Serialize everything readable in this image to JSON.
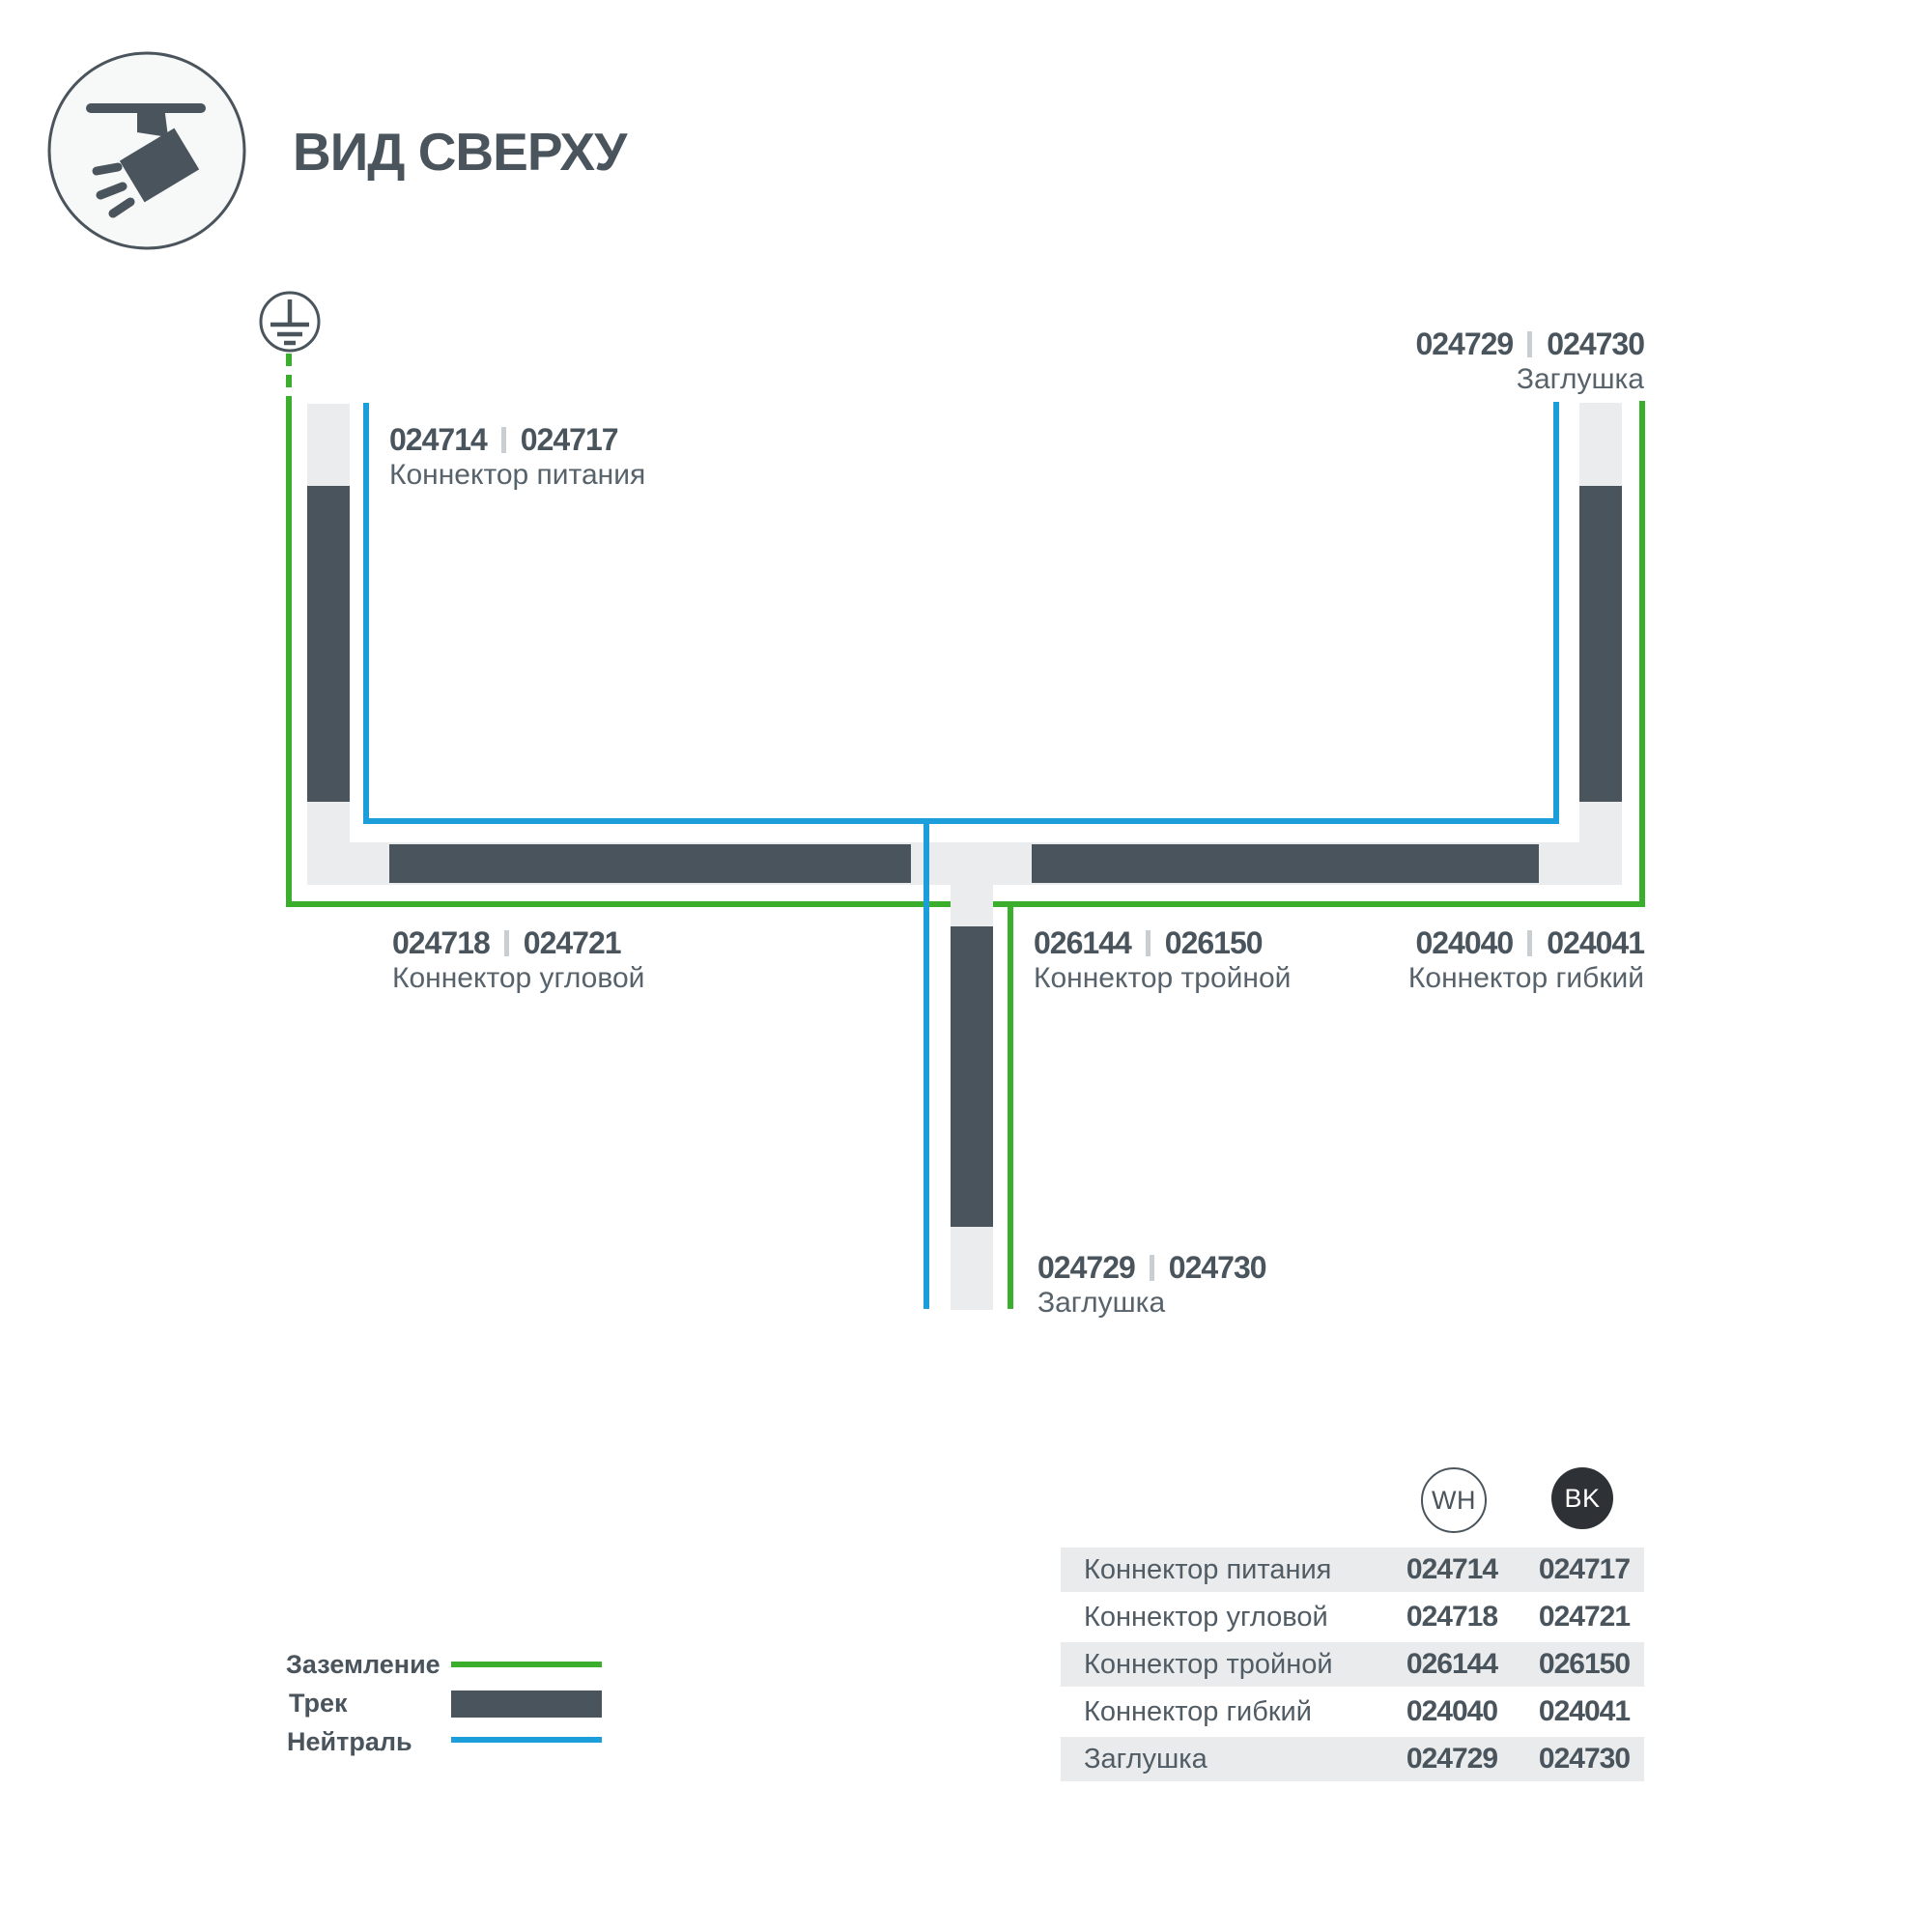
{
  "title": "ВИД СВЕРХУ",
  "icons": {
    "header": "track-spotlight-icon",
    "ground": "earth-ground-icon"
  },
  "colors": {
    "slate": "#4a545c",
    "rail_gray": "#ebeced",
    "ground_green": "#3bae2e",
    "neutral_blue": "#1b9ed9",
    "table_row_bg": "#e9ebec",
    "bk_badge": "#2e3236"
  },
  "diagram": {
    "labels": {
      "power": {
        "wh": "024714",
        "bk": "024717",
        "name": "Коннектор питания"
      },
      "endcap_top": {
        "wh": "024729",
        "bk": "024730",
        "name": "Заглушка"
      },
      "corner": {
        "wh": "024718",
        "bk": "024721",
        "name": "Коннектор угловой"
      },
      "triple": {
        "wh": "026144",
        "bk": "026150",
        "name": "Коннектор тройной"
      },
      "flex": {
        "wh": "024040",
        "bk": "024041",
        "name": "Коннектор гибкий"
      },
      "endcap_bottom": {
        "wh": "024729",
        "bk": "024730",
        "name": "Заглушка"
      }
    }
  },
  "legend": {
    "items": [
      {
        "label": "Заземление",
        "swatch": "green-line"
      },
      {
        "label": "Трек",
        "swatch": "track-bar"
      },
      {
        "label": "Нейтраль",
        "swatch": "blue-line"
      }
    ]
  },
  "table": {
    "col_wh": "WH",
    "col_bk": "BK",
    "rows": [
      {
        "label": "Коннектор питания",
        "wh": "024714",
        "bk": "024717"
      },
      {
        "label": "Коннектор угловой",
        "wh": "024718",
        "bk": "024721"
      },
      {
        "label": "Коннектор тройной",
        "wh": "026144",
        "bk": "026150"
      },
      {
        "label": "Коннектор гибкий",
        "wh": "024040",
        "bk": "024041"
      },
      {
        "label": "Заглушка",
        "wh": "024729",
        "bk": "024730"
      }
    ]
  }
}
